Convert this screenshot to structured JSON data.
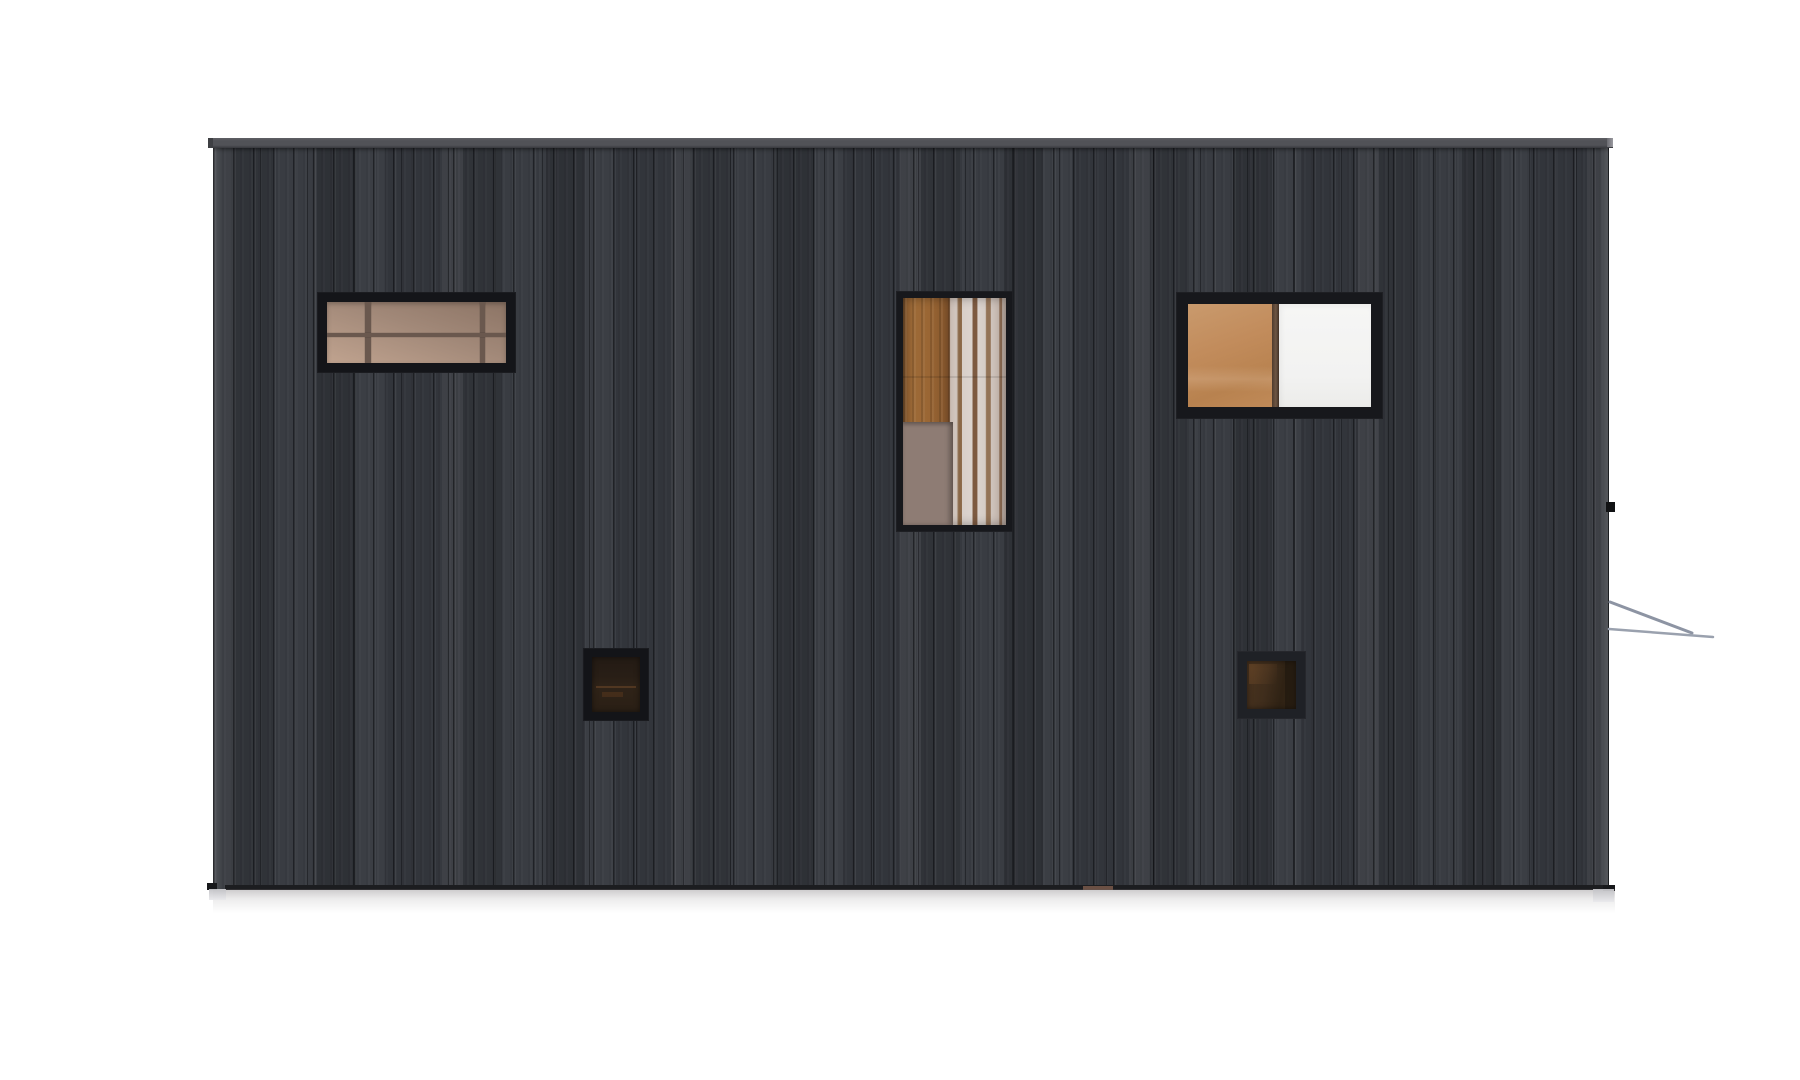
{
  "scene": {
    "description": "Architectural side-elevation rendering of a flat-roofed cabin clad in dark charred vertical timber boards with five black-framed windows, on a white background",
    "background_color": "#ffffff",
    "colors": {
      "wall-base": "#35383e",
      "roof-cap": "#515257",
      "roof-cap-edge": "#38393d",
      "base-line": "#1c1d20",
      "muntin": "#6a584e",
      "counter": "#8e7c74",
      "white-pane": "#f3f3f2",
      "railing-line": "#9aa1ae",
      "railing-line-dark": "#8d94a3"
    },
    "building": {
      "roof_cap": {
        "rect": {
          "x": 208,
          "y": 138,
          "w": 1405,
          "h": 10
        }
      },
      "wall": {
        "rect": {
          "x": 213,
          "y": 148,
          "w": 1396,
          "h": 741
        }
      },
      "base_line": {
        "rect": {
          "x": 225,
          "y": 885,
          "w": 1384,
          "h": 5
        }
      },
      "door_sill": {
        "rect": {
          "x": 1083,
          "y": 886,
          "w": 30,
          "h": 4
        },
        "color": "#6b5044"
      },
      "left_foot": {
        "rect": {
          "x": 207,
          "y": 883,
          "w": 10,
          "h": 7
        }
      },
      "right_foot": {
        "rect": {
          "x": 1603,
          "y": 885,
          "w": 12,
          "h": 6
        }
      },
      "fixture_tick": {
        "rect": {
          "x": 1606,
          "y": 502,
          "w": 9,
          "h": 10
        },
        "color": "#111214"
      },
      "footing_left": {
        "rect": {
          "x": 209,
          "y": 889,
          "w": 17,
          "h": 11
        }
      },
      "footing_right": {
        "rect": {
          "x": 1593,
          "y": 889,
          "w": 21,
          "h": 13
        }
      },
      "ground_shadow": {
        "rect": {
          "x": 213,
          "y": 889,
          "w": 1402,
          "h": 24
        }
      },
      "railing": {
        "rect": {
          "x": 1600,
          "y": 590,
          "w": 130,
          "h": 60
        },
        "line1": {
          "x1": 10,
          "y1": 12,
          "x2": 92,
          "y2": 43
        },
        "line2": {
          "x1": 9,
          "y1": 39,
          "x2": 113,
          "y2": 47
        }
      },
      "windows": {
        "clerestory": {
          "rect": {
            "x": 317,
            "y": 292,
            "w": 199,
            "h": 81
          },
          "frame": "#141519"
        },
        "tall": {
          "rect": {
            "x": 896,
            "y": 291,
            "w": 117,
            "h": 241
          },
          "frame": "#17181c"
        },
        "split": {
          "rect": {
            "x": 1176,
            "y": 292,
            "w": 207,
            "h": 127
          },
          "frame": "#17181c"
        },
        "small_left": {
          "rect": {
            "x": 583,
            "y": 648,
            "w": 66,
            "h": 73
          },
          "frame": "#131418"
        },
        "small_right": {
          "rect": {
            "x": 1237,
            "y": 651,
            "w": 69,
            "h": 68
          },
          "frame": "#1f2126"
        }
      }
    }
  }
}
